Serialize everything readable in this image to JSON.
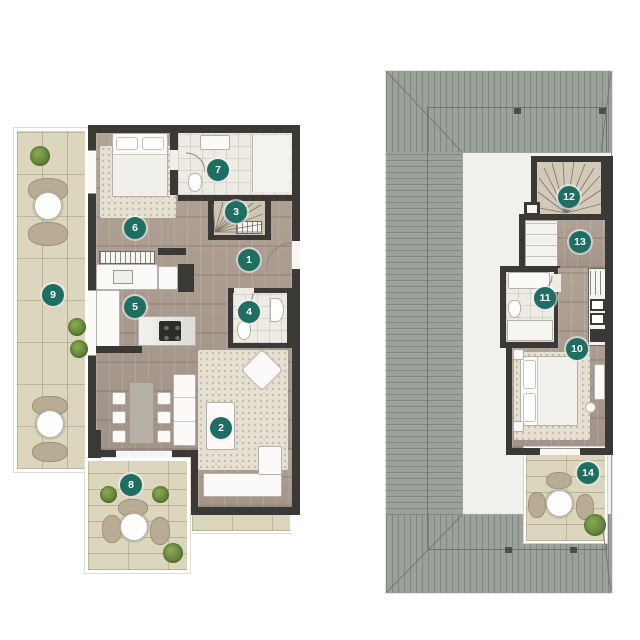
{
  "document": {
    "type": "floor-plan-sheet",
    "background": "#ffffff"
  },
  "colors": {
    "badge-bg": "#1e6f62",
    "badge-text": "#ffffff",
    "wall": "#3b3936",
    "wood": "#ab9c90",
    "tile": "#dbd6bd",
    "roof": "#9aa29b",
    "bath": "#edebe4",
    "rug": "#e6e0d2",
    "plant": "#6c8c3e"
  },
  "left_plan": {
    "badges": [
      "1",
      "2",
      "3",
      "4",
      "5",
      "6",
      "7",
      "8",
      "9"
    ]
  },
  "right_plan": {
    "badges": [
      "10",
      "11",
      "12",
      "13",
      "14"
    ]
  }
}
